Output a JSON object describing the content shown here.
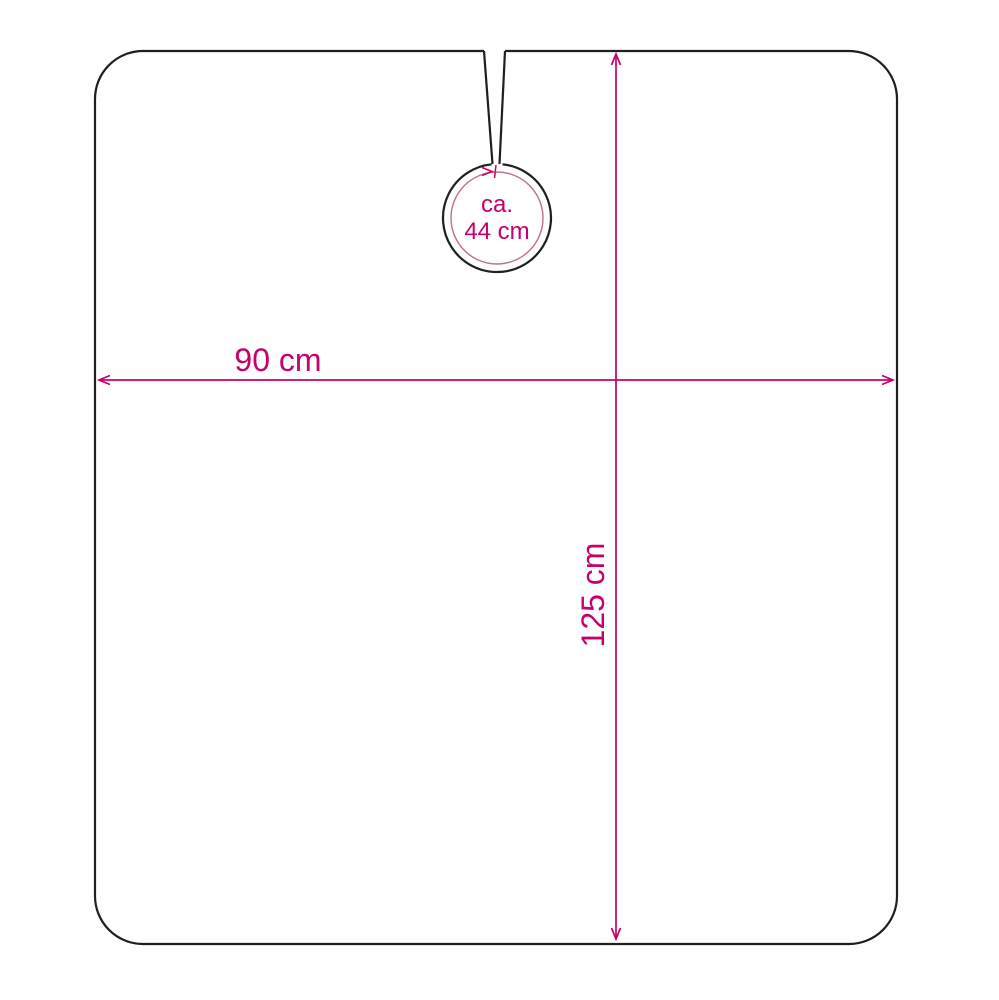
{
  "colors": {
    "background": "#ffffff",
    "outline": "#1f1f1f",
    "dimension": "#c7016a",
    "inner_circle": "#c06f8d"
  },
  "diagram": {
    "neck_label_line1": "ca.",
    "neck_label_line2": "44 cm",
    "width_label": "90 cm",
    "height_label": "125 cm"
  }
}
